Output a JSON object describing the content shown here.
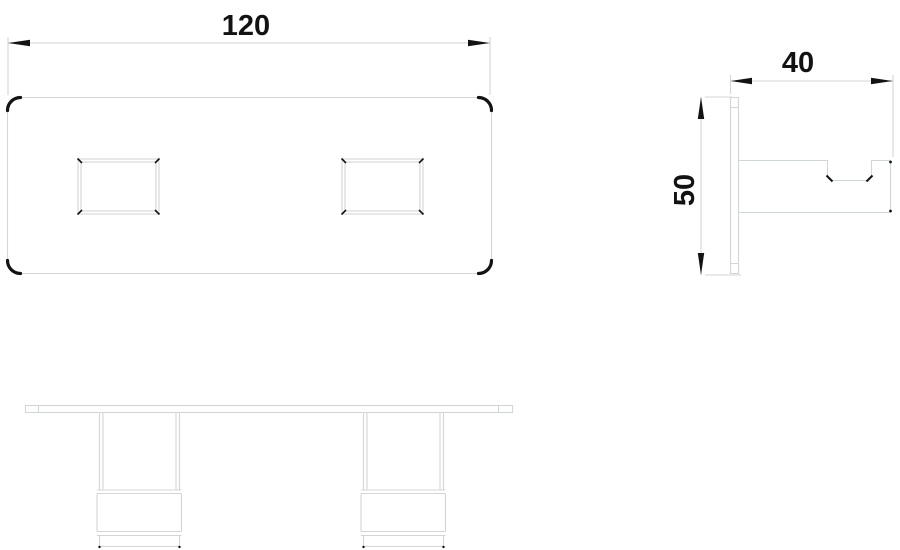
{
  "drawing": {
    "type": "technical-orthographic-drawing",
    "colors": {
      "line": "#d2d6d8",
      "accent": "#131313",
      "bg": "#ffffff"
    },
    "views": [
      {
        "id": "front",
        "name": "front-view",
        "description": "plate with rounded corners and two rectangular slots"
      },
      {
        "id": "side",
        "name": "side-view",
        "description": "wall plate with hook arm and top notch"
      },
      {
        "id": "bottom",
        "name": "bottom-view",
        "description": "thin bar with two stepped legs"
      }
    ],
    "dimensions": {
      "plate_width": {
        "label": "120"
      },
      "bracket_depth": {
        "label": "40"
      },
      "bracket_height": {
        "label": "50"
      }
    }
  }
}
